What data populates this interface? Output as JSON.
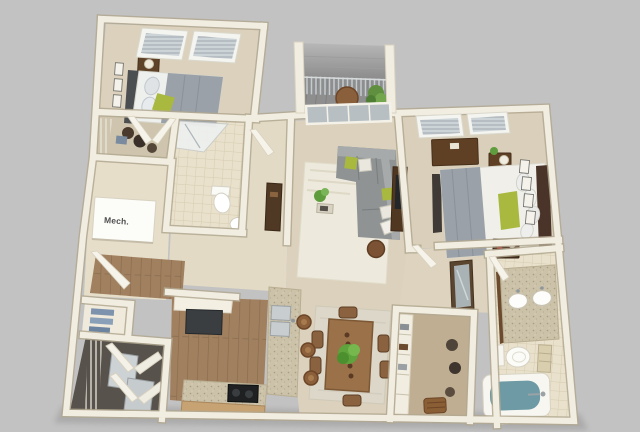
{
  "scene": {
    "type": "3d-apartment-floorplan-render",
    "background_color": "#c2c2c2",
    "labels": {
      "mech_closet": "Mech."
    },
    "palette": {
      "wall": "#f2ede1",
      "wall_shadow": "#b2a890",
      "carpet": "#dbd1bc",
      "tile": "#e9e1cc",
      "wood_floor": "#a0805f",
      "granite": "#cbc2a9",
      "balcony_floor": "#8e8e8e",
      "roof_gray": "#a8a8a8",
      "sofa_gray": "#8f9394",
      "bedding_gray": "#9aa1a9",
      "accent_green": "#a9b93f",
      "furniture_brown": "#6b4a2e",
      "bathtub_water": "#6d9aa4",
      "appliance_dark": "#3a3e41"
    },
    "rooms": [
      {
        "id": "bedroom-1",
        "contents": [
          "bed",
          "nightstand",
          "lamp",
          "wall-art",
          "two-windows",
          "walk-in-closet"
        ]
      },
      {
        "id": "bathroom-1",
        "contents": [
          "shower",
          "toilet",
          "pedestal-sink"
        ]
      },
      {
        "id": "mechanical-closet",
        "label": "Mech."
      },
      {
        "id": "balcony",
        "contents": [
          "railing",
          "bistro-table",
          "potted-plant",
          "sliding-glass-door",
          "roof-overhang"
        ]
      },
      {
        "id": "living-room",
        "contents": [
          "sectional-sofa",
          "throw-pillows",
          "area-rug",
          "plant",
          "side-table",
          "media-console"
        ]
      },
      {
        "id": "bedroom-2",
        "contents": [
          "bed",
          "dresser",
          "two-nightstands",
          "lamp",
          "wall-art",
          "two-windows"
        ]
      },
      {
        "id": "bathroom-2",
        "contents": [
          "double-vanity",
          "two-sinks",
          "toilet",
          "towel-rack",
          "bathtub"
        ]
      },
      {
        "id": "walk-in-closet-2",
        "contents": [
          "shelving",
          "hanging-clothes",
          "basket"
        ]
      },
      {
        "id": "dining-area",
        "contents": [
          "dining-table",
          "six-chairs",
          "centerpiece-plant",
          "area-rug"
        ]
      },
      {
        "id": "kitchen",
        "contents": [
          "granite-counters",
          "breakfast-bar",
          "bar-stools",
          "double-sink",
          "range",
          "refrigerator",
          "cabinets"
        ]
      },
      {
        "id": "entry-laundry",
        "contents": [
          "entry-door",
          "linen-closet",
          "washer-dryer",
          "wire-shelving"
        ]
      }
    ]
  }
}
